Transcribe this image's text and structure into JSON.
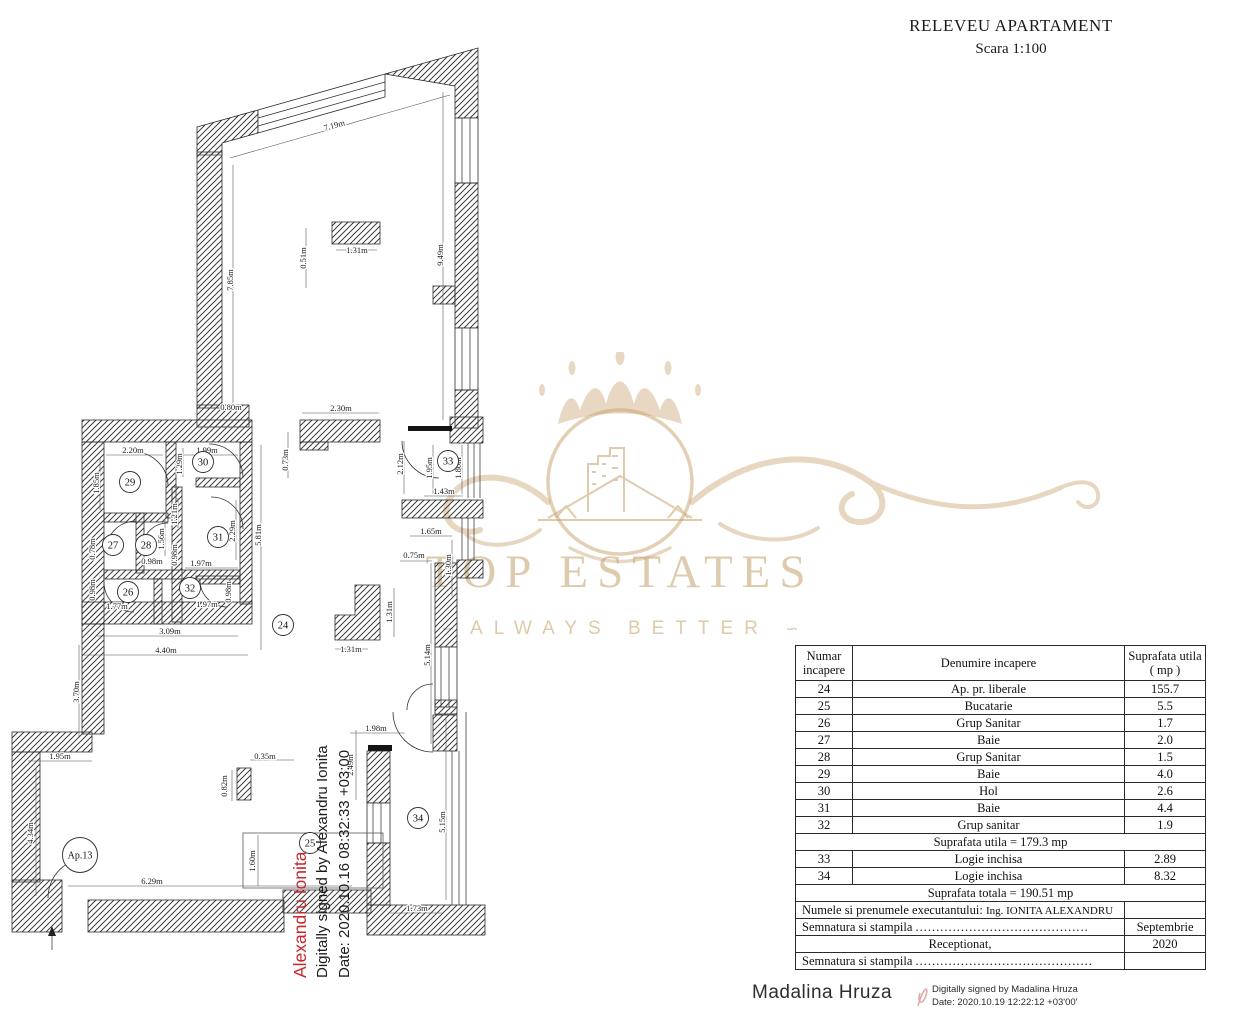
{
  "title_block": {
    "title": "RELEVEU APARTAMENT",
    "scale": "Scara 1:100"
  },
  "watermark": {
    "brand": "TOP ESTATES",
    "tagline": "ALWAYS BETTER",
    "ornament_left": "∽",
    "ornament_right": "∽",
    "gold": "#c8a06a"
  },
  "plan": {
    "rooms": [
      "24",
      "25",
      "26",
      "27",
      "28",
      "29",
      "30",
      "31",
      "32",
      "33",
      "34",
      "Ap.13"
    ],
    "dims": [
      "7.19m",
      "7.85m",
      "9.49m",
      "0.51m",
      "1.31m",
      "0.80m",
      "2.30m",
      "0.73m",
      "2.20m",
      "1.99m",
      "1.85m",
      "1.29m",
      "1.21m",
      "1.56m",
      "0.98m",
      "2.29m",
      "0.98m",
      "1.97m",
      "0.78m",
      "0.98m",
      "1.77m",
      "1.97m",
      "0.98m",
      "3.09m",
      "4.40m",
      "3.70m",
      "5.81m",
      "2.12m",
      "1.95m",
      "1.80m",
      "1.43m",
      "1.65m",
      "1.30m",
      "0.75m",
      "5.14m",
      "1.31m",
      "1.31m",
      "1.95m",
      "4.34m",
      "6.29m",
      "0.82m",
      "0.35m",
      "1.60m",
      "2.49m",
      "1.98m",
      "5.15m",
      "1.73m"
    ]
  },
  "table": {
    "header": {
      "col1": "Numar incapere",
      "col2": "Denumire incapere",
      "col3": "Suprafata utila ( mp )"
    },
    "rows": [
      {
        "nr": "24",
        "name": "Ap. pr. liberale",
        "area": "155.7"
      },
      {
        "nr": "25",
        "name": "Bucatarie",
        "area": "5.5"
      },
      {
        "nr": "26",
        "name": "Grup Sanitar",
        "area": "1.7"
      },
      {
        "nr": "27",
        "name": "Baie",
        "area": "2.0"
      },
      {
        "nr": "28",
        "name": "Grup Sanitar",
        "area": "1.5"
      },
      {
        "nr": "29",
        "name": "Baie",
        "area": "4.0"
      },
      {
        "nr": "30",
        "name": "Hol",
        "area": "2.6"
      },
      {
        "nr": "31",
        "name": "Baie",
        "area": "4.4"
      },
      {
        "nr": "32",
        "name": "Grup sanitar",
        "area": "1.9"
      }
    ],
    "subtotal_utila": "Suprafata utila = 179.3 mp",
    "rows_logii": [
      {
        "nr": "33",
        "name": "Logie inchisa",
        "area": "2.89"
      },
      {
        "nr": "34",
        "name": "Logie inchisa",
        "area": "8.32"
      }
    ],
    "total": "Suprafata totala = 190.51 mp",
    "executant_label": "Numele si prenumele executantului:",
    "executant_value": "Ing. IONITA ALEXANDRU",
    "semnatura1_label": "Semnatura si stampila",
    "semnatura1_dots": "..........................................",
    "month": "Septembrie",
    "receptionat": "Receptionat,",
    "year": "2020",
    "semnatura2_label": "Semnatura si stampila",
    "semnatura2_dots": "..........................................."
  },
  "signatures": {
    "alexandru": {
      "name": "Alexandru Ionita",
      "line1": "Digitally signed by Alexandru Ionita",
      "line2": "Date: 2020.10.16 08:32:33 +03:00",
      "name_color": "#c4272e"
    },
    "madalina": {
      "name": "Madalina Hruza",
      "line1": "Digitally signed by Madalina Hruza",
      "line2": "Date: 2020.10.19 12:22:12 +03'00'"
    }
  }
}
